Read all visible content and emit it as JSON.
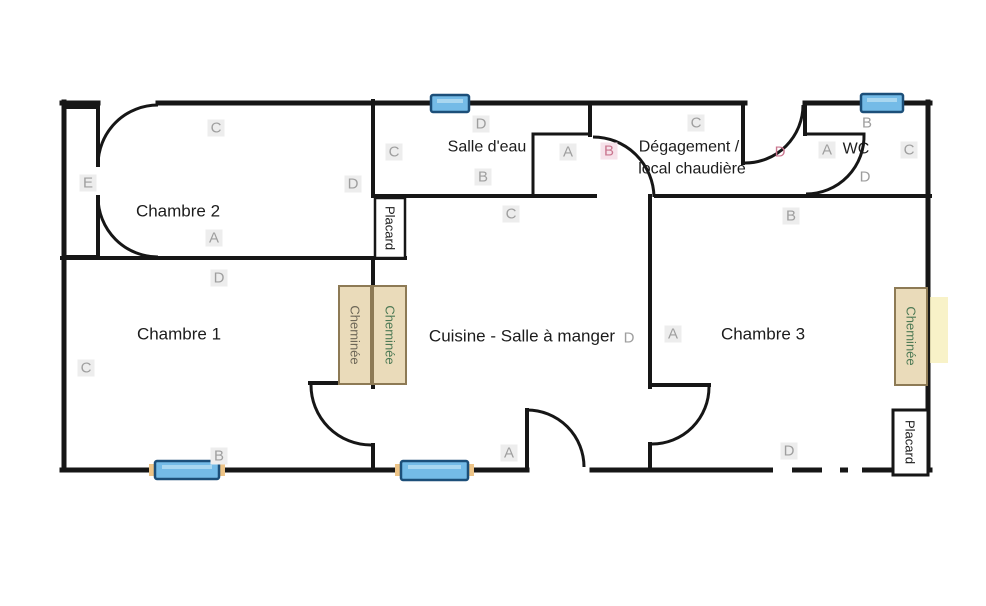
{
  "colors": {
    "wall": "#161616",
    "window_fill": "#74bbe7",
    "window_border": "#1c4f79",
    "chimney_fill": "#eadbba",
    "chimney_border": "#8d7a55",
    "marker_gray": "#9e9e9e",
    "marker_accent": "#c9758e",
    "label_text": "#1c1c1c"
  },
  "rooms": {
    "chambre1": "Chambre 1",
    "chambre2": "Chambre 2",
    "chambre3": "Chambre 3",
    "cuisine": "Cuisine - Salle à manger",
    "salle_eau": "Salle d'eau",
    "degagement_line1": "Dégagement /",
    "degagement_line2": "local chaudière",
    "wc": "WC"
  },
  "features": {
    "placard_top": "Placard",
    "placard_bottom": "Placard",
    "cheminee_left": "Cheminée",
    "cheminee_right": "Cheminée",
    "cheminee_chambre3": "Cheminée"
  },
  "markers": [
    {
      "room": "chambre-2",
      "side": "top",
      "label": "C",
      "accent": false
    },
    {
      "room": "chambre-2",
      "side": "left",
      "label": "E",
      "accent": false
    },
    {
      "room": "chambre-2",
      "side": "right",
      "label": "D",
      "accent": false
    },
    {
      "room": "chambre-2",
      "side": "bottom",
      "label": "A",
      "accent": false
    },
    {
      "room": "chambre-1",
      "side": "top",
      "label": "D",
      "accent": false
    },
    {
      "room": "chambre-1",
      "side": "left",
      "label": "C",
      "accent": false
    },
    {
      "room": "chambre-1",
      "side": "bottom",
      "label": "B",
      "accent": false
    },
    {
      "room": "salle-d-eau",
      "side": "top",
      "label": "D",
      "accent": false
    },
    {
      "room": "salle-d-eau",
      "side": "left",
      "label": "C",
      "accent": false
    },
    {
      "room": "salle-d-eau",
      "side": "right",
      "label": "A",
      "accent": false
    },
    {
      "room": "salle-d-eau",
      "side": "bottom",
      "label": "B",
      "accent": false
    },
    {
      "room": "cuisine",
      "side": "top",
      "label": "C",
      "accent": false
    },
    {
      "room": "cuisine",
      "side": "right",
      "label": "D",
      "accent": false
    },
    {
      "room": "cuisine",
      "side": "bottom",
      "label": "A",
      "accent": false
    },
    {
      "room": "degagement",
      "side": "left",
      "label": "B",
      "accent": true
    },
    {
      "room": "degagement",
      "side": "top",
      "label": "C",
      "accent": false
    },
    {
      "room": "degagement",
      "side": "right",
      "label": "D",
      "accent": true
    },
    {
      "room": "wc",
      "side": "top",
      "label": "B",
      "accent": false
    },
    {
      "room": "wc",
      "side": "left",
      "label": "A",
      "accent": false
    },
    {
      "room": "wc",
      "side": "right",
      "label": "C",
      "accent": false
    },
    {
      "room": "wc",
      "side": "bottom",
      "label": "D",
      "accent": false
    },
    {
      "room": "chambre-3",
      "side": "top",
      "label": "B",
      "accent": false
    },
    {
      "room": "chambre-3",
      "side": "left",
      "label": "A",
      "accent": false
    },
    {
      "room": "chambre-3",
      "side": "bottom",
      "label": "D",
      "accent": false
    }
  ]
}
